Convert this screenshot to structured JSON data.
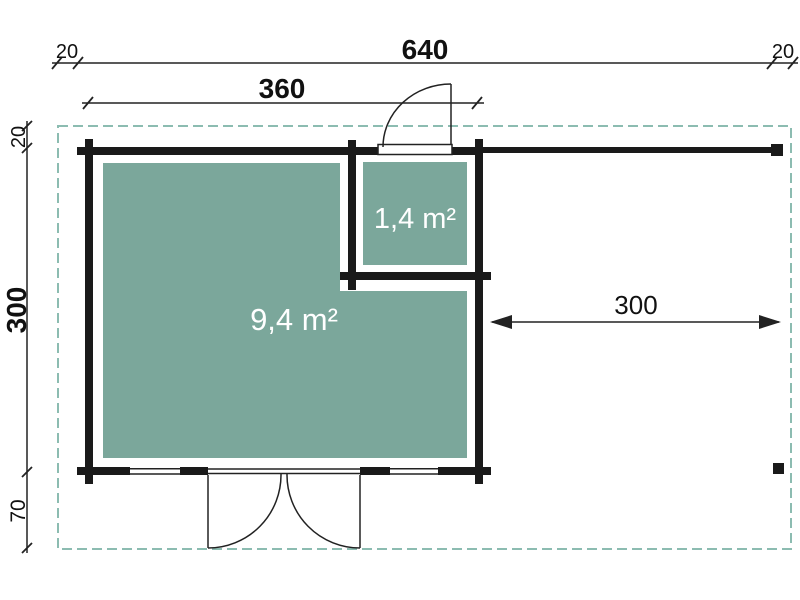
{
  "diagram": {
    "rooms": {
      "main_area": "9,4 m²",
      "annex_area": "1,4 m²"
    },
    "dimensions": {
      "total_width": "640",
      "overhang_left": "20",
      "overhang_right": "20",
      "cabin_width": "360",
      "overhang_top": "20",
      "cabin_depth": "300",
      "overhang_front": "70",
      "terrace_width": "300"
    }
  },
  "colors": {
    "room_fill": "#7BA79B",
    "roof_dash": "#8CBCB1",
    "wall": "#1A1A1A",
    "line": "#222222",
    "label": "#111111",
    "room_label": "#FFFFFF",
    "background": "#FFFFFF"
  }
}
